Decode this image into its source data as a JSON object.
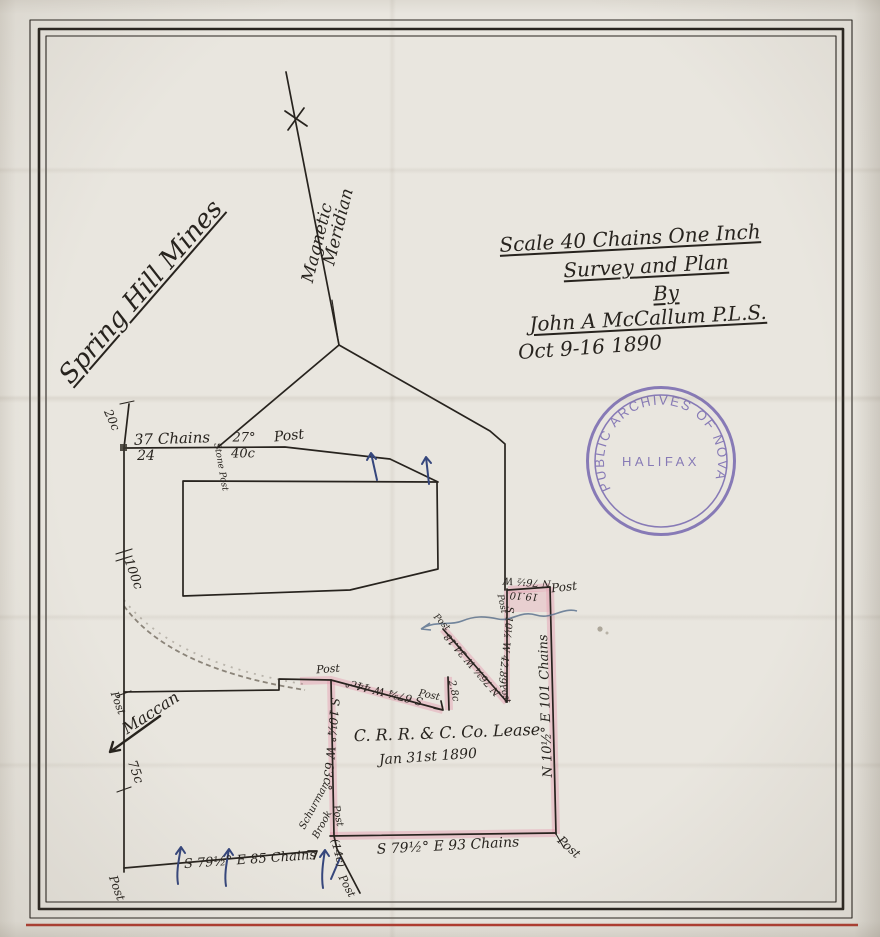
{
  "colors": {
    "ink": "#27231e",
    "blue_ink": "#35467c",
    "pink": "#e598ad",
    "stamp_purple": "#6c5dab",
    "brook_blue": "#5d7391",
    "red_border": "#b23a2e",
    "paper": "#e9e6df"
  },
  "stamp": {
    "ring_text": "PUBLIC ARCHIVES OF NOVA SCOTIA",
    "center_text": "HALIFAX"
  },
  "title_block": {
    "scale": "Scale 40 Chains One Inch",
    "survey": "Survey and Plan",
    "by": "By",
    "surveyor": "John A McCallum P.L.S.",
    "date": "Oct 9-16 1890"
  },
  "lease": {
    "title": "C. R. R. & C. Co. Lease",
    "date": "Jan 31st 1890"
  },
  "annotations": [
    {
      "name": "spring-hill-mines-label",
      "text": "Spring Hill Mines",
      "x": 141,
      "y": 292,
      "r": -49,
      "s": 26,
      "u": true
    },
    {
      "name": "magnetic-label",
      "text": "Magnetic",
      "x": 318,
      "y": 243,
      "r": -76,
      "s": 17
    },
    {
      "name": "meridian-label",
      "text": "Meridian",
      "x": 339,
      "y": 227,
      "r": -76,
      "s": 17
    },
    {
      "name": "title-scale",
      "text": "Scale 40 Chains One Inch",
      "x": 630,
      "y": 238,
      "r": -3,
      "s": 20,
      "u": true
    },
    {
      "name": "title-survey",
      "text": "Survey and Plan",
      "x": 646,
      "y": 266,
      "r": -3,
      "s": 20,
      "u": true
    },
    {
      "name": "title-by",
      "text": "By",
      "x": 666,
      "y": 293,
      "r": -3,
      "s": 20,
      "u": true
    },
    {
      "name": "title-surveyor",
      "text": "John A McCallum P.L.S.",
      "x": 648,
      "y": 318,
      "r": -3,
      "s": 20,
      "u": true
    },
    {
      "name": "title-date",
      "text": "Oct 9-16 1890",
      "x": 590,
      "y": 347,
      "r": -4,
      "s": 20
    },
    {
      "name": "dist-37-chains",
      "text": "37 Chains",
      "x": 172,
      "y": 439,
      "r": -2,
      "s": 15
    },
    {
      "name": "num-24",
      "text": "24",
      "x": 146,
      "y": 456,
      "r": 0,
      "s": 14
    },
    {
      "name": "dist-20c",
      "text": "20c",
      "x": 112,
      "y": 420,
      "r": 66,
      "s": 12
    },
    {
      "name": "stone-post-label",
      "text": "Stone Post",
      "x": 220,
      "y": 467,
      "r": 80,
      "s": 9
    },
    {
      "name": "angle-27",
      "text": "27°",
      "x": 244,
      "y": 438,
      "r": 0,
      "s": 13
    },
    {
      "name": "dist-40c",
      "text": "40c",
      "x": 243,
      "y": 454,
      "r": 0,
      "s": 13
    },
    {
      "name": "post-top-line",
      "text": "Post",
      "x": 289,
      "y": 436,
      "r": -6,
      "s": 14
    },
    {
      "name": "dist-100c",
      "text": "100c",
      "x": 133,
      "y": 574,
      "r": 70,
      "s": 13
    },
    {
      "name": "post-west-mid",
      "text": "Post",
      "x": 118,
      "y": 703,
      "r": 70,
      "s": 11
    },
    {
      "name": "maccan-label",
      "text": "Maccan",
      "x": 151,
      "y": 713,
      "r": -33,
      "s": 16
    },
    {
      "name": "dist-75c",
      "text": "75c",
      "x": 135,
      "y": 772,
      "r": 70,
      "s": 13
    },
    {
      "name": "post-west-bottom",
      "text": "Post",
      "x": 117,
      "y": 888,
      "r": 70,
      "s": 12
    },
    {
      "name": "bearing-85-chains",
      "text": "S 79½° E  85 Chains",
      "x": 250,
      "y": 860,
      "r": -4,
      "s": 13
    },
    {
      "name": "dist-14c",
      "text": "(14c)",
      "x": 338,
      "y": 853,
      "r": 76,
      "s": 11
    },
    {
      "name": "post-sw-diagonal",
      "text": "Post",
      "x": 347,
      "y": 886,
      "r": 62,
      "s": 11
    },
    {
      "name": "brook-name-1",
      "text": "Schurman",
      "x": 315,
      "y": 806,
      "r": -62,
      "s": 10
    },
    {
      "name": "brook-name-2",
      "text": "Brook",
      "x": 323,
      "y": 825,
      "r": -62,
      "s": 10
    },
    {
      "name": "post-step",
      "text": "Post",
      "x": 328,
      "y": 669,
      "r": -4,
      "s": 11
    },
    {
      "name": "bearing-44c",
      "text": "S 67¾ W 44c°",
      "x": 384,
      "y": 692,
      "r": 194,
      "s": 11
    },
    {
      "name": "post-44-end",
      "text": "Post",
      "x": 429,
      "y": 696,
      "r": 12,
      "s": 10
    },
    {
      "name": "dist-2-8c",
      "text": "2.8c",
      "x": 453,
      "y": 691,
      "r": 78,
      "s": 10
    },
    {
      "name": "post-3418-top",
      "text": "Post",
      "x": 441,
      "y": 623,
      "r": 46,
      "s": 9
    },
    {
      "name": "bearing-3418",
      "text": "N 76¾ W 34.18",
      "x": 473,
      "y": 664,
      "r": 229,
      "s": 10
    },
    {
      "name": "post-4289-top",
      "text": "Post",
      "x": 501,
      "y": 604,
      "r": 78,
      "s": 9
    },
    {
      "name": "bearing-7612",
      "text": "N 76½ W",
      "x": 527,
      "y": 581,
      "r": 184,
      "s": 10
    },
    {
      "name": "dist-1910",
      "text": "19.10",
      "x": 524,
      "y": 595,
      "r": 184,
      "s": 10
    },
    {
      "name": "post-ne",
      "text": "Post",
      "x": 564,
      "y": 587,
      "r": -6,
      "s": 12
    },
    {
      "name": "bearing-4289",
      "text": "S 10½ W 42.89",
      "x": 505,
      "y": 645,
      "r": 96,
      "s": 10
    },
    {
      "name": "post-4289-bottom",
      "text": "Post",
      "x": 504,
      "y": 694,
      "r": 72,
      "s": 9
    },
    {
      "name": "bearing-101-chains",
      "text": "N 10½° E  101 Chains",
      "x": 546,
      "y": 706,
      "r": -92,
      "s": 13
    },
    {
      "name": "bearing-63c",
      "text": "S 10¼° W 63c°",
      "x": 331,
      "y": 744,
      "r": 95,
      "s": 12
    },
    {
      "name": "post-west-lease",
      "text": "Post",
      "x": 337,
      "y": 816,
      "r": 78,
      "s": 10
    },
    {
      "name": "lease-title",
      "text": "C. R. R. & C. Co. Lease",
      "x": 447,
      "y": 733,
      "r": -2,
      "s": 16
    },
    {
      "name": "lease-date",
      "text": "Jan 31st 1890",
      "x": 428,
      "y": 757,
      "r": -4,
      "s": 14
    },
    {
      "name": "bearing-93-chains",
      "text": "S 79½° E  93 Chains",
      "x": 448,
      "y": 846,
      "r": -3,
      "s": 14
    },
    {
      "name": "post-se",
      "text": "Post",
      "x": 569,
      "y": 847,
      "r": 42,
      "s": 12
    }
  ]
}
